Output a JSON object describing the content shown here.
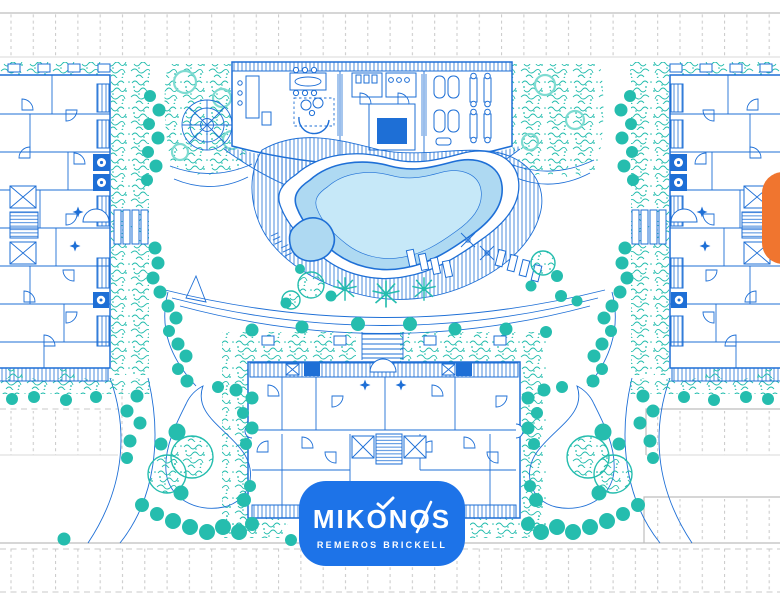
{
  "logo": {
    "title": "MIKONOS",
    "subtitle": "REMEROS BRICKELL"
  },
  "colors": {
    "plan_blue": "#1e6fd6",
    "teal": "#25bdae",
    "teal_light": "#7edbd1",
    "pool_fill": "#aed9f2",
    "pool_inner": "#c6e8f8",
    "badge_blue": "#1d73e8",
    "orange": "#f0752f",
    "gray_line": "#bdbdbd",
    "paper": "#ffffff"
  }
}
